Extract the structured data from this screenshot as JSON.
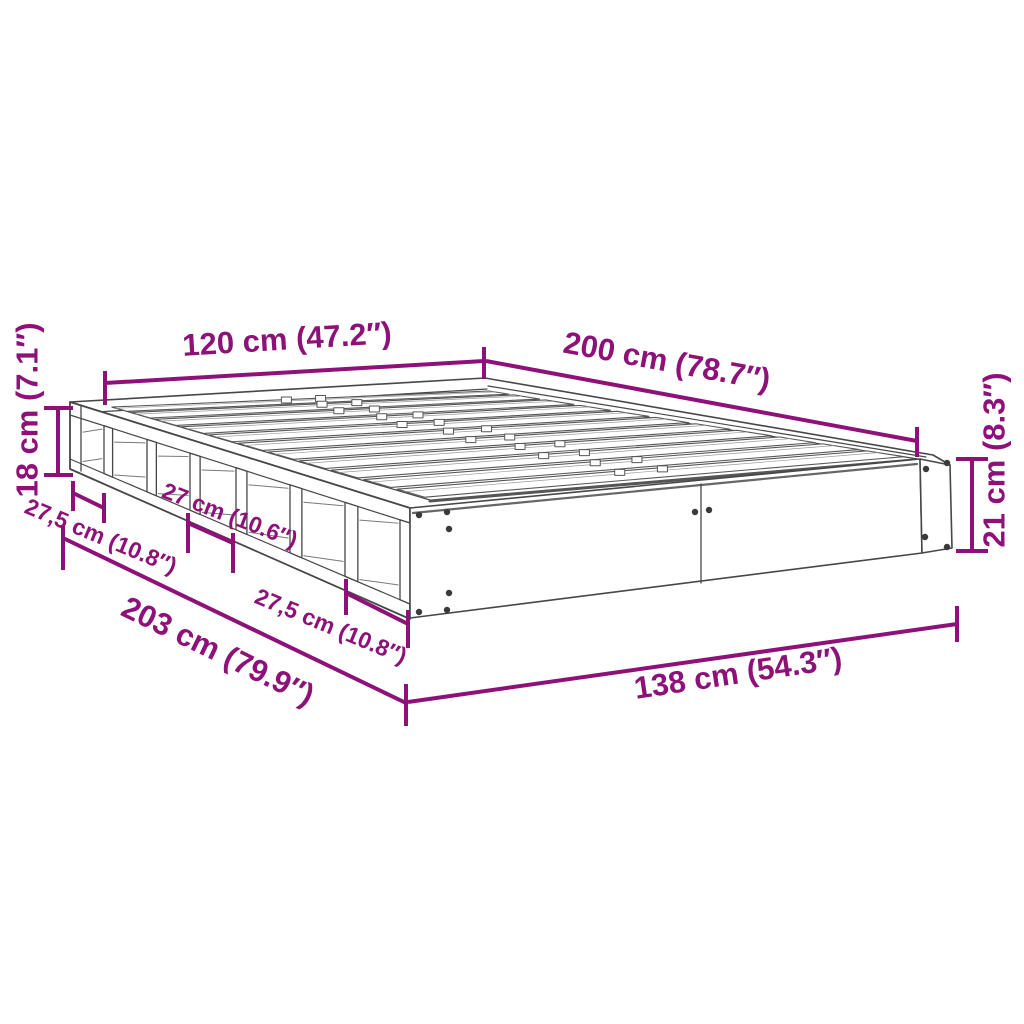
{
  "diagram": {
    "subject": "bed-frame-isometric-line-drawing",
    "background_color": "#ffffff",
    "accent_color": "#8E1179",
    "line_color": "#444444",
    "dims": {
      "width_top": "120 cm (47.2″)",
      "length_top": "200 cm (78.7″)",
      "height_side": "18 cm (7.1″)",
      "compartment_first": "27,5 cm (10.8″)",
      "compartment_mid": "27 cm (10.6″)",
      "length_bottom": "203 cm (79.9″)",
      "compartment_last": "27,5 cm (10.8″)",
      "width_bottom": "138 cm (54.3″)",
      "height_front": "21 cm (8.3″)"
    }
  }
}
